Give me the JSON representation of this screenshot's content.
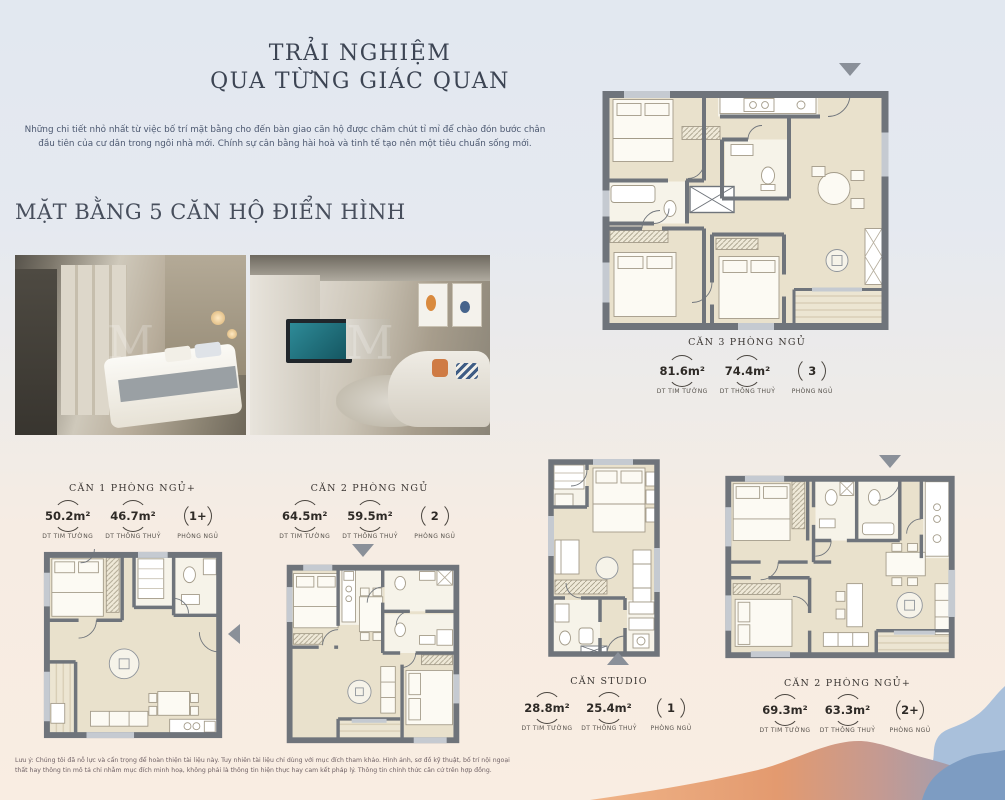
{
  "header": {
    "title_line1": "TRẢI NGHIỆM",
    "title_line2": "QUA TỪNG GIÁC QUAN",
    "intro": "Những chi tiết nhỏ nhất từ việc bố trí mặt bằng cho đến bàn giao căn hộ được chăm chút tỉ mỉ để chào đón bước chân đầu tiên của cư dân trong ngôi nhà mới. Chính sự cân bằng hài hoà và tinh tế tạo nên một tiêu chuẩn sống mới.",
    "section_heading": "MẶT BẰNG 5 CĂN HỘ ĐIỂN HÌNH"
  },
  "watermark": "M",
  "units": [
    {
      "id": "can-3-phong-ngu",
      "name": "CĂN 3 PHÒNG NGỦ",
      "stats": [
        {
          "value": "81.6m²",
          "label": "DT TIM TƯỜNG"
        },
        {
          "value": "74.4m²",
          "label": "DT THÔNG THUỶ"
        },
        {
          "value": "3",
          "label": "PHÒNG NGỦ"
        }
      ]
    },
    {
      "id": "can-1-phong-ngu-plus",
      "name": "CĂN 1 PHÒNG NGỦ+",
      "stats": [
        {
          "value": "50.2m²",
          "label": "DT TIM TƯỜNG"
        },
        {
          "value": "46.7m²",
          "label": "DT THÔNG THUỶ"
        },
        {
          "value": "1+",
          "label": "PHÒNG NGỦ"
        }
      ]
    },
    {
      "id": "can-2-phong-ngu",
      "name": "CĂN 2 PHÒNG NGỦ",
      "stats": [
        {
          "value": "64.5m²",
          "label": "DT TIM TƯỜNG"
        },
        {
          "value": "59.5m²",
          "label": "DT THÔNG THUỶ"
        },
        {
          "value": "2",
          "label": "PHÒNG NGỦ"
        }
      ]
    },
    {
      "id": "can-studio",
      "name": "CĂN STUDIO",
      "stats": [
        {
          "value": "28.8m²",
          "label": "DT TIM TƯỜNG"
        },
        {
          "value": "25.4m²",
          "label": "DT THÔNG THUỶ"
        },
        {
          "value": "1",
          "label": "PHÒNG NGỦ"
        }
      ]
    },
    {
      "id": "can-2-phong-ngu-plus",
      "name": "CĂN 2 PHÒNG NGỦ+",
      "stats": [
        {
          "value": "69.3m²",
          "label": "DT TIM TƯỜNG"
        },
        {
          "value": "63.3m²",
          "label": "DT THÔNG THUỶ"
        },
        {
          "value": "2+",
          "label": "PHÒNG NGỦ"
        }
      ]
    }
  ],
  "footer": {
    "disclaimer": "Lưu ý: Chúng tôi đã nỗ lực và cẩn trọng để hoàn thiện tài liệu này. Tuy nhiên tài liệu chỉ dùng với mục đích tham khảo. Hình ảnh, sơ đồ kỹ thuật, bố trí nội ngoại thất hay thông tin mô tả chỉ nhằm mục đích minh hoạ, không phải là thông tin hiện thực hay cam kết pháp lý. Thông tin chính thức căn cứ trên hợp đồng."
  },
  "colors": {
    "wall": "#6f747b",
    "floor": "#e9e1cc",
    "wave_orange": "#e29a6e",
    "wave_blue_light": "#a9c0db",
    "wave_blue_deep": "#7d9cc2"
  }
}
